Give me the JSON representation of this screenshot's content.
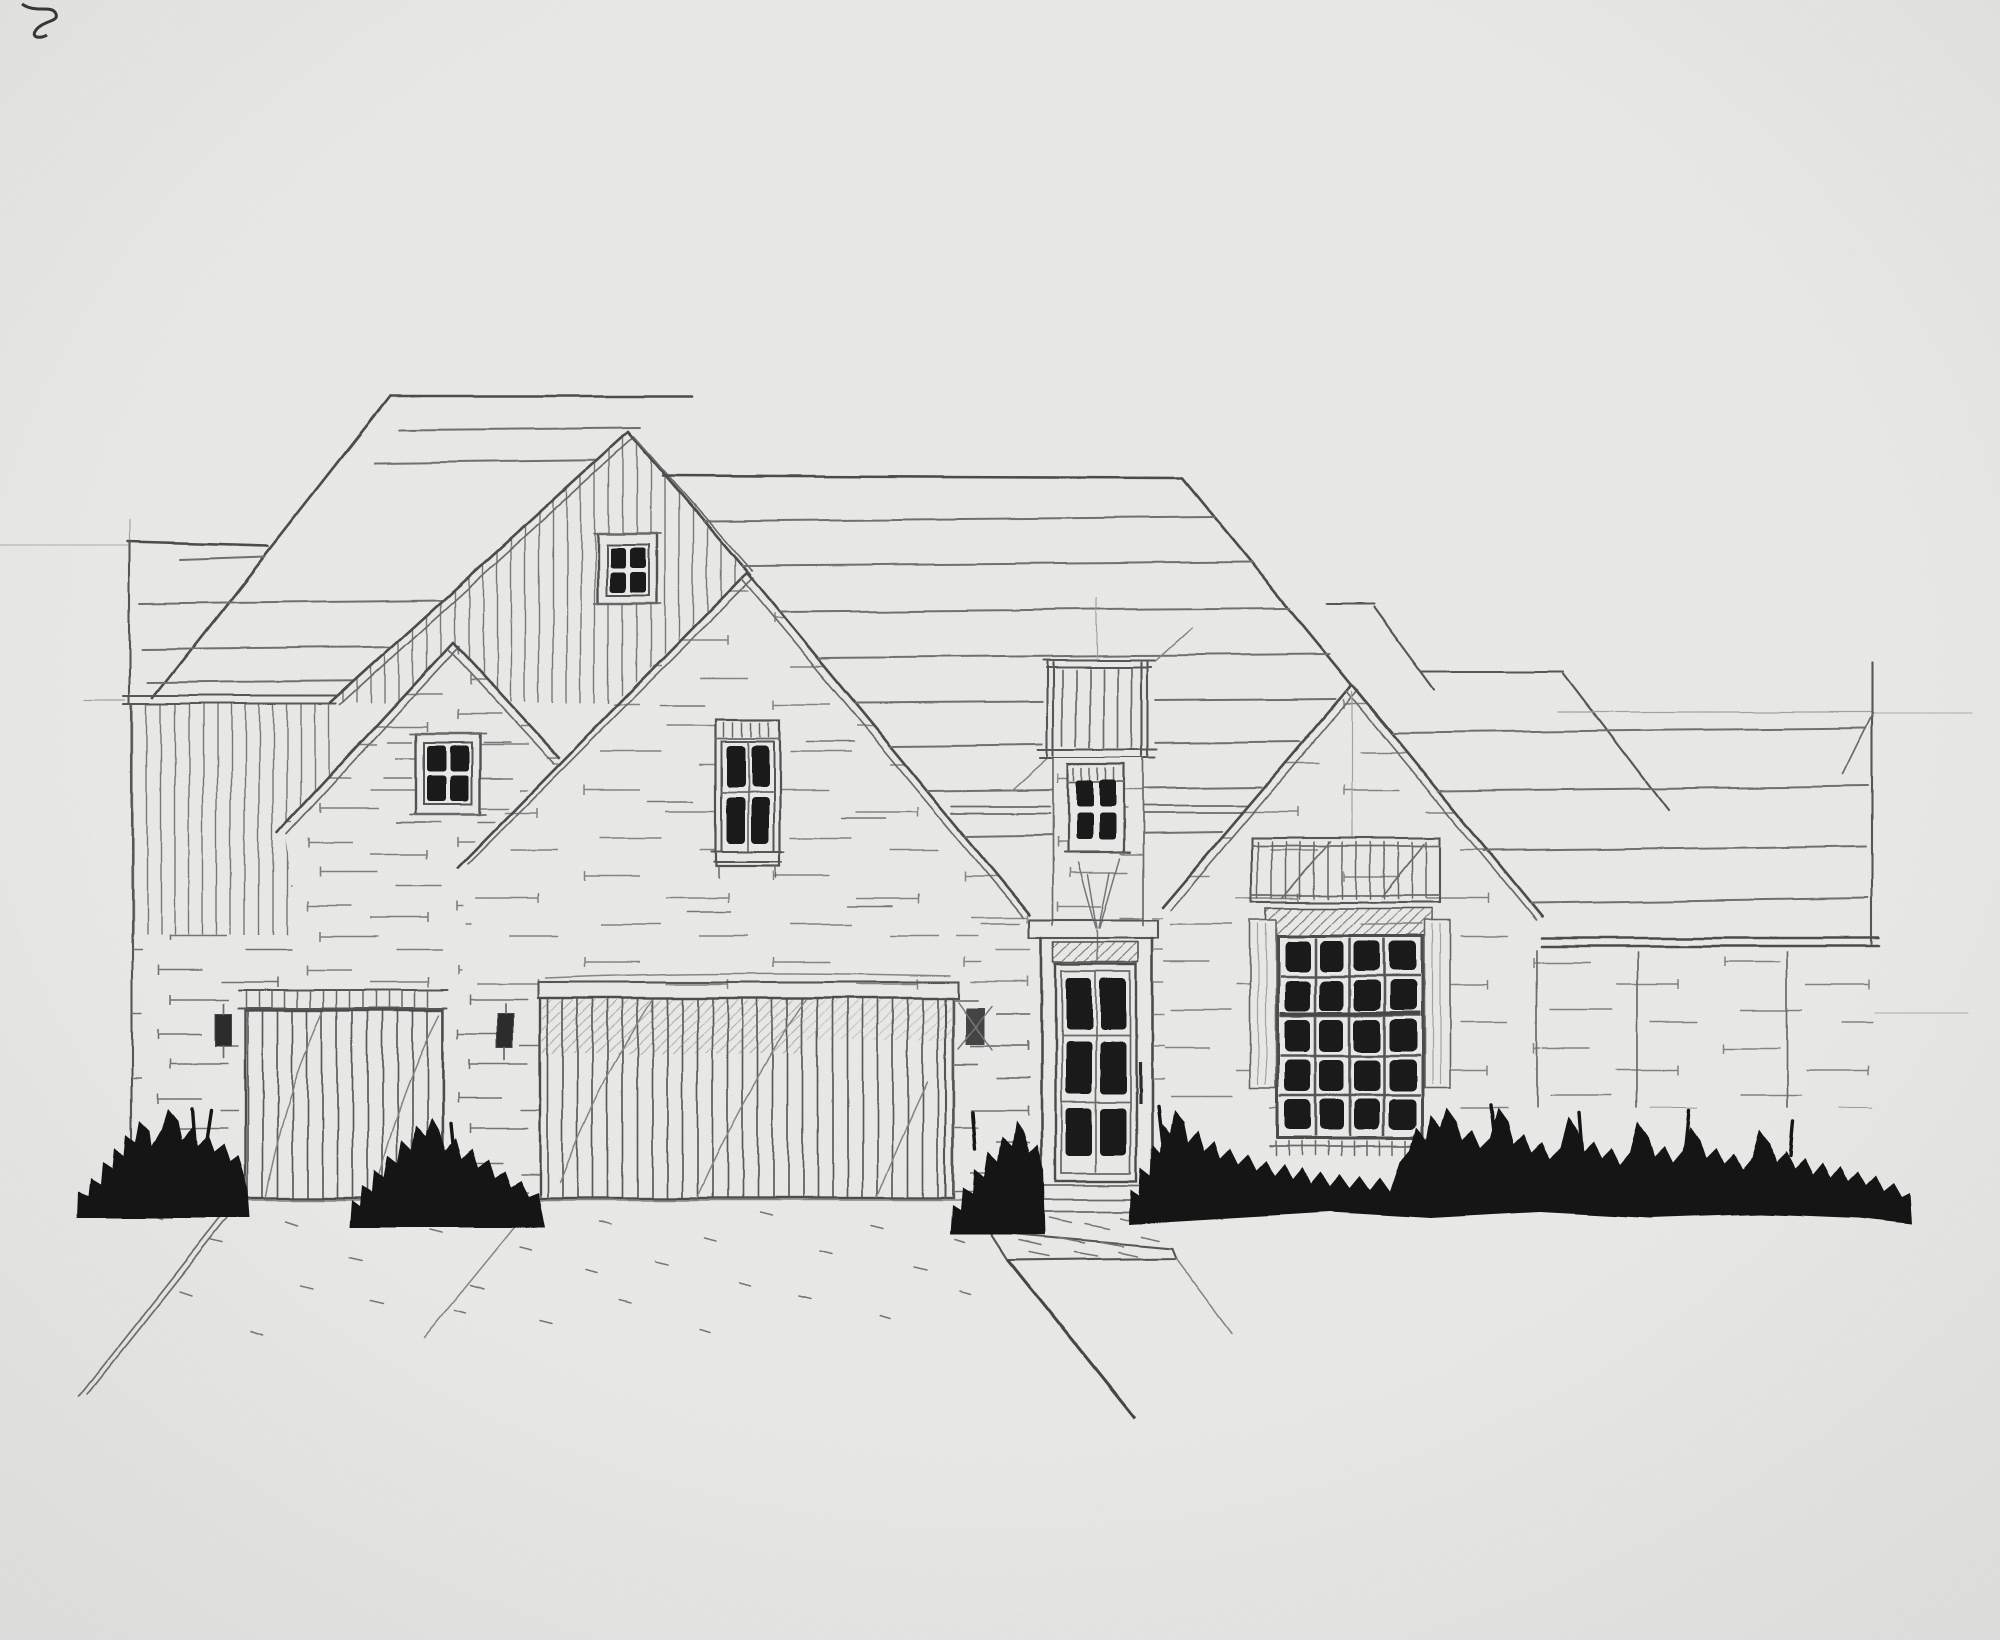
{
  "scene": {
    "title": "Hand-drawn architectural front-elevation sketch of a single-story brick house, rendered in pencil with heavy black ink shrubs along the foundation",
    "medium": "pencil and ink marker on white paper",
    "paper_color": "#f1f1ef",
    "pencil_color": "#4f4f4f",
    "ink_color": "#161616"
  },
  "house": {
    "gables": [
      {
        "label": "board-and-batten gable",
        "cladding": "vertical siding"
      },
      {
        "label": "small left gable",
        "cladding": "brick"
      },
      {
        "label": "central great gable",
        "cladding": "brick"
      },
      {
        "label": "right gable",
        "cladding": "brick"
      }
    ],
    "windows": [
      {
        "label": "board-and-batten gable window",
        "panes": "2x2"
      },
      {
        "label": "small left gable window",
        "panes": "2x2"
      },
      {
        "label": "central gable window",
        "panes": "2x2 tall with transom ticks"
      },
      {
        "label": "entry dormer window",
        "panes": "2x2"
      },
      {
        "label": "great-room window",
        "panes": "4x5",
        "shutters": true,
        "trellis_above": true
      }
    ],
    "front_door": {
      "panes": "2x3",
      "transom": "hatched",
      "flanked_by_shrubs": true
    },
    "garage": {
      "doors": [
        {
          "label": "single garage door",
          "style": "vertical slats, ticked header"
        },
        {
          "label": "double garage door",
          "style": "vertical slats, shaded lintel"
        }
      ],
      "sconces": 3
    },
    "roof": {
      "style": "steep gables with hips",
      "texture": "wavy hand-drawn shingle course lines"
    },
    "landscaping": {
      "style": "solid black ink shrub row",
      "clusters": 5
    },
    "sitework": {
      "driveway": "pencil edge lines with pebble ticks",
      "front_walk": "stooped pad with hatching"
    }
  }
}
